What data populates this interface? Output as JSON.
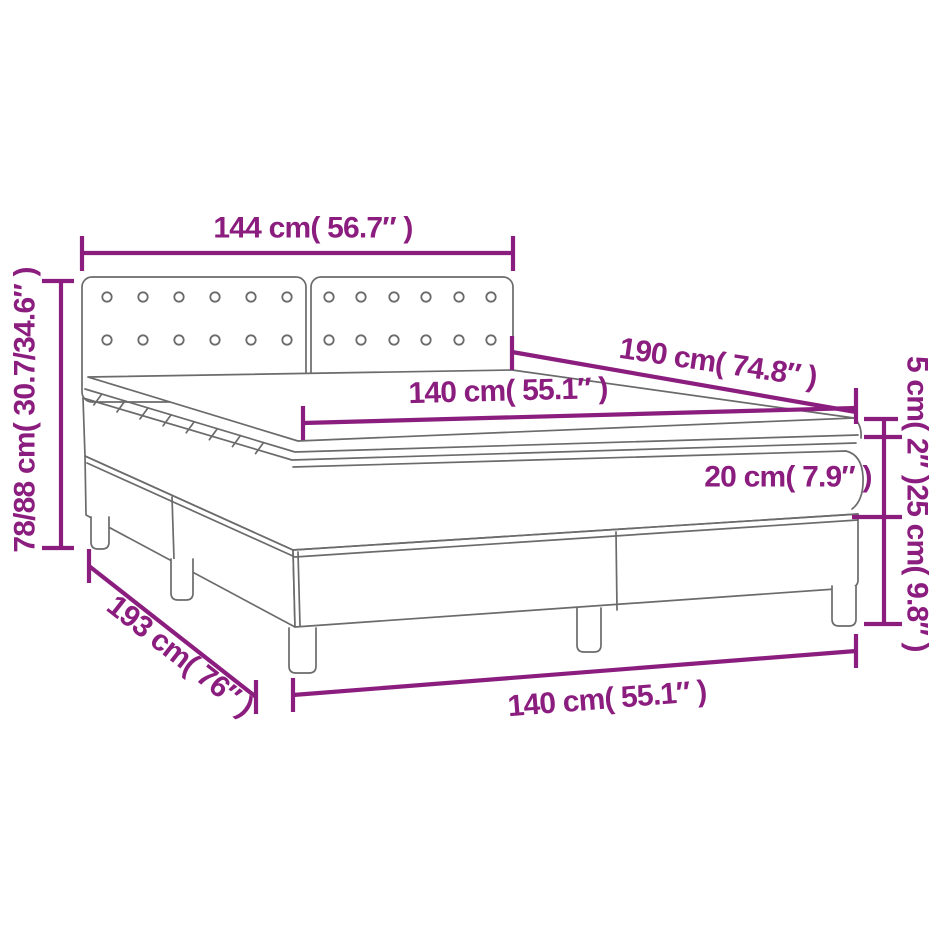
{
  "colors": {
    "dimension": "#8B1D7F",
    "outline": "#6b6b6b",
    "background": "#ffffff"
  },
  "dimensions": {
    "headboard_width": "144 cm( 56.7″ )",
    "total_height": "78/88 cm( 30.7/34.6″ )",
    "length": "190 cm( 74.8″ )",
    "mattress_width": "140 cm( 55.1″ )",
    "topper_height": "5 cm( 2″ )",
    "mattress_height": "20 cm( 7.9″ )",
    "base_height": "25 cm( 9.8″ )",
    "base_length": "193 cm( 76″ )",
    "base_width": "140 cm( 55.1″ )"
  }
}
